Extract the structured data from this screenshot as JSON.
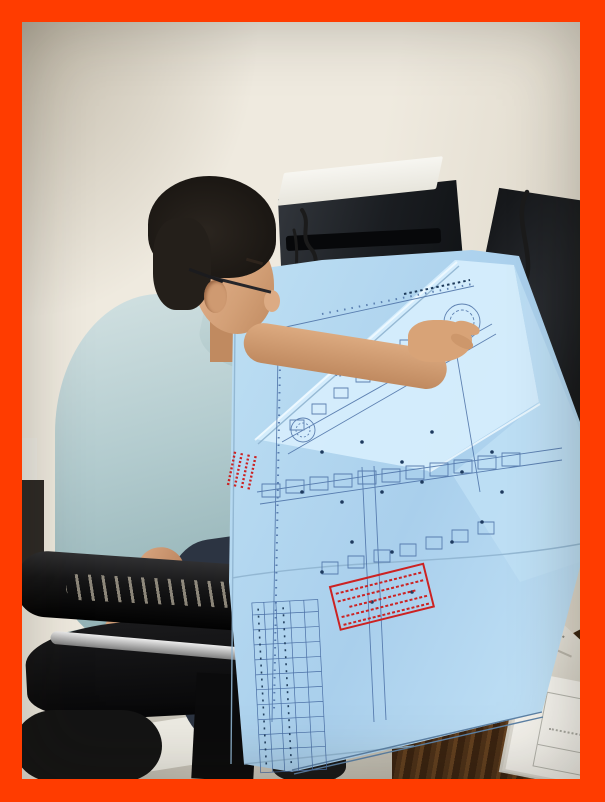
{
  "frame": {
    "border_color": "#ff3c00",
    "border_widths_px": {
      "left": 22,
      "top": 22,
      "right": 25,
      "bottom": 23
    }
  },
  "photo": {
    "description": "Man in light blue polo shirt and glasses seated in a worn black office chair, leaning over a large folded light-blue architectural blueprint spread across a dark wooden desk; beige curtain and off-white wall behind, black PC tower with paper on top and black monitor in background, white papers and envelope at lower right, grey tiled floor below.",
    "no_visible_legible_text": true,
    "palette": {
      "curtain_beige": "#c9b795",
      "wall_offwhite": "#e9e4d8",
      "shirt_blue": "#b2cbce",
      "skin": "#d3a077",
      "hair_black": "#1b1713",
      "blueprint_paper": "#bcdef3",
      "blueprint_linework": "#4a6fa5",
      "stamp_red": "#cc2222",
      "chair_leather_black": "#121213",
      "chair_chrome": "#bcbcbc",
      "desk_wood_brown": "#4d3118",
      "floor_grey": "#c5c1b6",
      "monitor_black": "#17191c",
      "paper_white": "#f4f2ec"
    },
    "objects": [
      {
        "name": "curtain"
      },
      {
        "name": "wall"
      },
      {
        "name": "computer-tower"
      },
      {
        "name": "monitor"
      },
      {
        "name": "man"
      },
      {
        "name": "blueprint"
      },
      {
        "name": "red-approval-stamps"
      },
      {
        "name": "office-chair"
      },
      {
        "name": "desk"
      },
      {
        "name": "papers"
      },
      {
        "name": "floor"
      }
    ]
  }
}
